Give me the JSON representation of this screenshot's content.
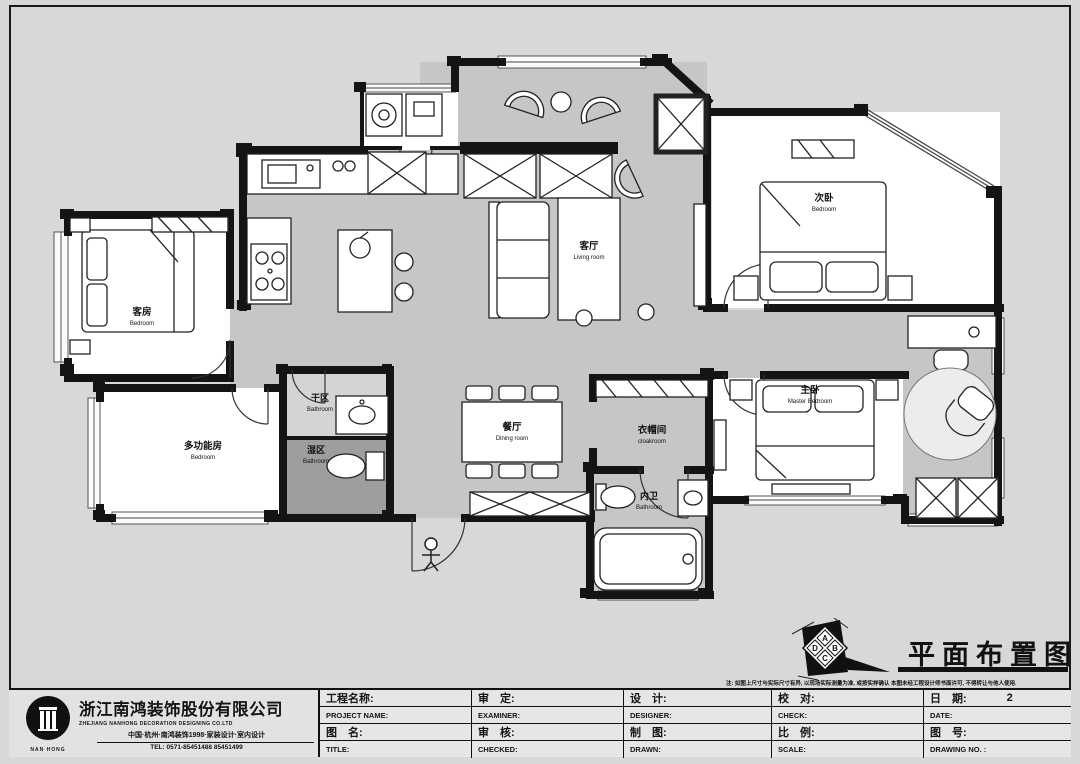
{
  "sheet": {
    "drawing_title": "平面布置图",
    "note": "注: 如图上尺寸与实际尺寸有异, 以现场实际测量为准, 或按实样确认 本图未经工程设计师书面许可, 不得转让与他人使用.",
    "compass": {
      "a": "A",
      "b": "B",
      "c": "C",
      "d": "D"
    }
  },
  "company": {
    "name_zh": "浙江南鸿装饰股份有限公司",
    "name_en": "ZHEJIANG NANHONG DECORATION DESIGNING CO.LTD",
    "tagline": "中国·杭州·南鸿装饰1998·家装设计·室内设计",
    "tel": "TEL: 0571-85451488 85451499",
    "logo_text": "NAN HONG"
  },
  "title_block": {
    "columns": [
      {
        "row1_zh": "工程名称:",
        "row1_en": "PROJECT NAME:",
        "row2_zh": "图　名:",
        "row2_en": "TITLE:",
        "row1_value": "",
        "row2_value": ""
      },
      {
        "row1_zh": "审　定:",
        "row1_en": "EXAMINER:",
        "row2_zh": "审　核:",
        "row2_en": "CHECKED:",
        "row1_value": "",
        "row2_value": ""
      },
      {
        "row1_zh": "设　计:",
        "row1_en": "DESIGNER:",
        "row2_zh": "制　图:",
        "row2_en": "DRAWN:",
        "row1_value": "",
        "row2_value": ""
      },
      {
        "row1_zh": "校　对:",
        "row1_en": "CHECK:",
        "row2_zh": "比　例:",
        "row2_en": "SCALE:",
        "row1_value": "",
        "row2_value": ""
      },
      {
        "row1_zh": "日　期:",
        "row1_en": "DATE:",
        "row2_zh": "图　号:",
        "row2_en": "DRAWING NO. :",
        "row1_value": "2",
        "row2_value": ""
      }
    ]
  },
  "rooms": {
    "living": {
      "zh": "客厅",
      "en": "Living room"
    },
    "dining": {
      "zh": "餐厅",
      "en": "Dining room"
    },
    "guest_bedroom": {
      "zh": "客房",
      "en": "Bedroom"
    },
    "multi_room": {
      "zh": "多功能房",
      "en": "Bedroom"
    },
    "dry_area": {
      "zh": "干区",
      "en": "Bathroom"
    },
    "wet_area": {
      "zh": "湿区",
      "en": "Bathroom"
    },
    "cloakroom": {
      "zh": "衣帽间",
      "en": "cloakroom"
    },
    "ensuite": {
      "zh": "内卫",
      "en": "Bathroom"
    },
    "second_bedroom": {
      "zh": "次卧",
      "en": "Bedroom"
    },
    "master_bedroom": {
      "zh": "主卧",
      "en": "Master Bedroom"
    }
  },
  "colors": {
    "page_bg": "#d8d8d8",
    "floor_gray": "#c6c6c6",
    "wet_gray": "#9e9e9e",
    "wall_black": "#141414",
    "room_white": "#ffffff"
  }
}
